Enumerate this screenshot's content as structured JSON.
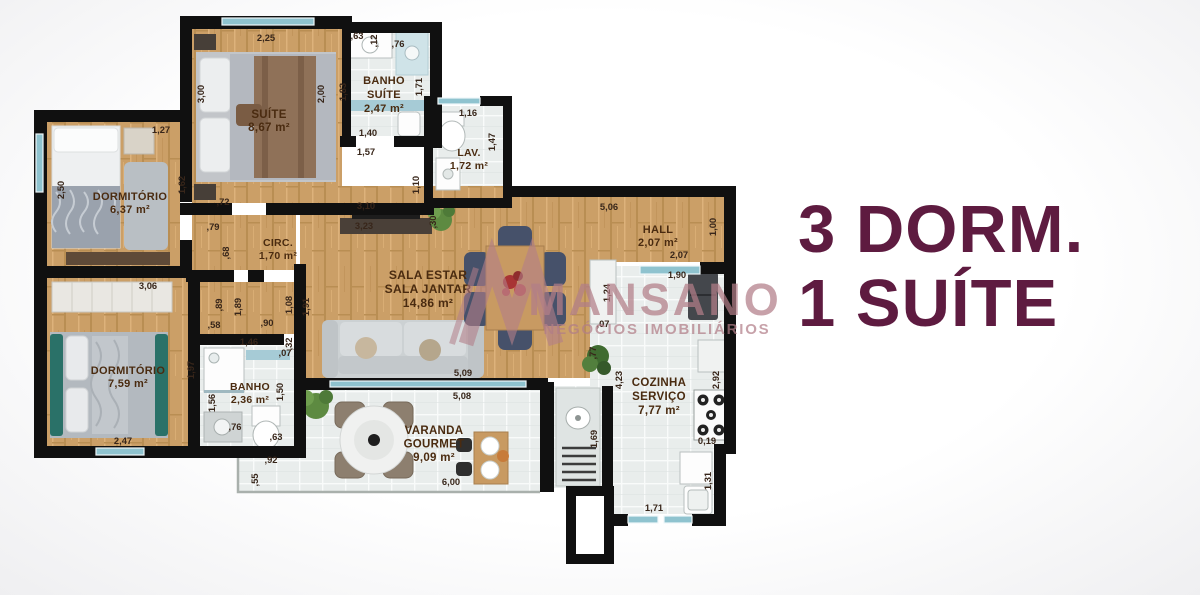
{
  "title": {
    "line1": "3 DORM.",
    "line2": "1 SUÍTE"
  },
  "watermark": {
    "name": "MANSANO",
    "tagline": "NEGÓCIOS IMOBILIÁRIOS"
  },
  "colors": {
    "title": "#5e1b40",
    "watermark": "#b27e88",
    "wall": "#101010",
    "wood_floor": "#cb9f67",
    "tile_floor": "#e9edec",
    "dimension_text": "#38261a",
    "room_text": "#4a2b10"
  },
  "plan": {
    "rooms": [
      {
        "name": "suite",
        "label": [
          "SUÍTE",
          "8,67 m²"
        ],
        "x": 269,
        "y": 118,
        "lh": 13,
        "fs": 11.5
      },
      {
        "name": "banho-suite",
        "label": [
          "BANHO",
          "SUÍTE",
          "2,47 m²"
        ],
        "x": 384,
        "y": 84,
        "lh": 14,
        "fs": 11
      },
      {
        "name": "lavabo",
        "label": [
          "LAV.",
          "1,72 m²"
        ],
        "x": 469,
        "y": 156,
        "lh": 13,
        "fs": 10.5
      },
      {
        "name": "dormitorio-1",
        "label": [
          "DORMITÓRIO",
          "6,37 m²"
        ],
        "x": 130,
        "y": 200,
        "lh": 13,
        "fs": 11
      },
      {
        "name": "circulacao",
        "label": [
          "CIRC.",
          "1,70 m²"
        ],
        "x": 278,
        "y": 246,
        "lh": 13,
        "fs": 10.5
      },
      {
        "name": "sala",
        "label": [
          "SALA ESTAR",
          "SALA JANTAR",
          "14,86 m²"
        ],
        "x": 428,
        "y": 279,
        "lh": 14,
        "fs": 12
      },
      {
        "name": "hall",
        "label": [
          "HALL",
          "2,07 m²"
        ],
        "x": 658,
        "y": 233,
        "lh": 13,
        "fs": 11
      },
      {
        "name": "dormitorio-2",
        "label": [
          "DORMITÓRIO",
          "7,59 m²"
        ],
        "x": 128,
        "y": 374,
        "lh": 13,
        "fs": 11
      },
      {
        "name": "banho",
        "label": [
          "BANHO",
          "2,36 m²"
        ],
        "x": 250,
        "y": 390,
        "lh": 13,
        "fs": 10.5
      },
      {
        "name": "varanda-gourmet",
        "label": [
          "VARANDA",
          "GOURMET",
          "9,09 m²"
        ],
        "x": 434,
        "y": 434,
        "lh": 13.5,
        "fs": 11.5
      },
      {
        "name": "cozinha-servico",
        "label": [
          "COZINHA",
          "SERVIÇO",
          "7,77 m²"
        ],
        "x": 659,
        "y": 386,
        "lh": 14,
        "fs": 11.5
      }
    ],
    "dimensions": [
      {
        "t": "2,25",
        "x": 266,
        "y": 41
      },
      {
        "t": ",63",
        "x": 357,
        "y": 39
      },
      {
        "t": ",12",
        "x": 377,
        "y": 41,
        "v": 1
      },
      {
        "t": ",76",
        "x": 398,
        "y": 47
      },
      {
        "t": "3,00",
        "x": 204,
        "y": 94,
        "v": 1
      },
      {
        "t": "2,00",
        "x": 324,
        "y": 94,
        "v": 1
      },
      {
        "t": "1,83",
        "x": 346,
        "y": 92,
        "v": 1
      },
      {
        "t": "1,71",
        "x": 422,
        "y": 87,
        "v": 1
      },
      {
        "t": "1,40",
        "x": 368,
        "y": 136
      },
      {
        "t": "1,57",
        "x": 366,
        "y": 155
      },
      {
        "t": "1,16",
        "x": 468,
        "y": 116
      },
      {
        "t": "1,47",
        "x": 495,
        "y": 142,
        "v": 1
      },
      {
        "t": "1,10",
        "x": 419,
        "y": 185,
        "v": 1
      },
      {
        "t": "3,10",
        "x": 366,
        "y": 209
      },
      {
        "t": "3,23",
        "x": 364,
        "y": 229
      },
      {
        "t": ",30",
        "x": 436,
        "y": 222,
        "v": 1
      },
      {
        "t": "1,27",
        "x": 161,
        "y": 133
      },
      {
        "t": "2,50",
        "x": 64,
        "y": 190,
        "v": 1
      },
      {
        "t": "1,62",
        "x": 185,
        "y": 185,
        "v": 1
      },
      {
        "t": ",72",
        "x": 223,
        "y": 205
      },
      {
        "t": ",79",
        "x": 213,
        "y": 230
      },
      {
        "t": ",68",
        "x": 229,
        "y": 253,
        "v": 1
      },
      {
        "t": ",89",
        "x": 222,
        "y": 305,
        "v": 1
      },
      {
        "t": "1,89",
        "x": 241,
        "y": 307,
        "v": 1
      },
      {
        "t": "1,08",
        "x": 292,
        "y": 305,
        "v": 1
      },
      {
        "t": "1,91",
        "x": 309,
        "y": 307,
        "v": 1
      },
      {
        "t": ",58",
        "x": 214,
        "y": 328
      },
      {
        "t": ",90",
        "x": 267,
        "y": 326
      },
      {
        "t": "5,06",
        "x": 609,
        "y": 210
      },
      {
        "t": "1,00",
        "x": 716,
        "y": 227,
        "v": 1
      },
      {
        "t": "2,07",
        "x": 679,
        "y": 258
      },
      {
        "t": "1,90",
        "x": 677,
        "y": 278
      },
      {
        "t": "1,24",
        "x": 610,
        "y": 293,
        "v": 1
      },
      {
        "t": ",07",
        "x": 603,
        "y": 327
      },
      {
        "t": ",77",
        "x": 596,
        "y": 353,
        "v": 1
      },
      {
        "t": "3,06",
        "x": 148,
        "y": 289
      },
      {
        "t": "1,97",
        "x": 194,
        "y": 370,
        "v": 1
      },
      {
        "t": "2,47",
        "x": 123,
        "y": 444
      },
      {
        "t": "1,46",
        "x": 249,
        "y": 345
      },
      {
        "t": ",32",
        "x": 292,
        "y": 344,
        "v": 1
      },
      {
        "t": ",07",
        "x": 285,
        "y": 356
      },
      {
        "t": "1,50",
        "x": 283,
        "y": 392,
        "v": 1
      },
      {
        "t": "1,56",
        "x": 215,
        "y": 403,
        "v": 1
      },
      {
        "t": ",76",
        "x": 235,
        "y": 430
      },
      {
        "t": ",63",
        "x": 276,
        "y": 440
      },
      {
        "t": ",92",
        "x": 271,
        "y": 463
      },
      {
        "t": ",55",
        "x": 258,
        "y": 480,
        "v": 1
      },
      {
        "t": "5,09",
        "x": 463,
        "y": 376
      },
      {
        "t": "5,08",
        "x": 462,
        "y": 399
      },
      {
        "t": "6,00",
        "x": 451,
        "y": 485
      },
      {
        "t": "4,23",
        "x": 622,
        "y": 380,
        "v": 1
      },
      {
        "t": "2,92",
        "x": 719,
        "y": 380,
        "v": 1
      },
      {
        "t": "0,19",
        "x": 707,
        "y": 444
      },
      {
        "t": "1,31",
        "x": 711,
        "y": 481,
        "v": 1
      },
      {
        "t": "1,71",
        "x": 654,
        "y": 511
      },
      {
        "t": "1,69",
        "x": 597,
        "y": 439,
        "v": 1
      }
    ]
  }
}
